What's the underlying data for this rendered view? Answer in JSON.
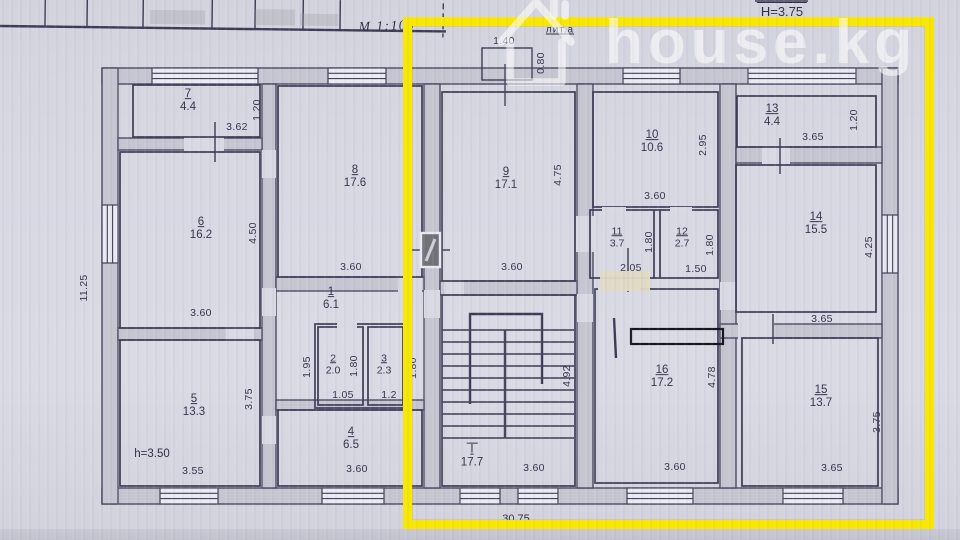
{
  "watermark": {
    "text": "house.kg"
  },
  "header": {
    "height_note": "Н=3.75",
    "scale_note": "М 1:100",
    "liter_label": "лит.а"
  },
  "overall": {
    "width": "30.75",
    "depth": "11.25",
    "ceiling_note": "h=3.50",
    "porch_width": "1.40",
    "porch_depth": "0.80",
    "lobby_depth": "1.95"
  },
  "rooms": {
    "r1": {
      "num": "1",
      "area": "6.1"
    },
    "r2": {
      "num": "2",
      "area": "2.0",
      "w": "1.05",
      "h": "1.80"
    },
    "r3": {
      "num": "3",
      "area": "2.3",
      "w": "1.2",
      "h": "1.80"
    },
    "r4": {
      "num": "4",
      "area": "6.5",
      "w": "3.60"
    },
    "r5": {
      "num": "5",
      "area": "13.3",
      "w": "3.55",
      "h": "3.75"
    },
    "r6": {
      "num": "6",
      "area": "16.2",
      "w": "3.60",
      "h": "4.50"
    },
    "r7": {
      "num": "7",
      "area": "4.4",
      "w": "3.62",
      "h": "1.20"
    },
    "r8": {
      "num": "8",
      "area": "17.6",
      "w": "3.60",
      "h": "4.75"
    },
    "r9": {
      "num": "9",
      "area": "17.1",
      "w": "3.60",
      "h": "4.75"
    },
    "r10": {
      "num": "10",
      "area": "10.6",
      "w": "3.60",
      "h": "2.95"
    },
    "r11": {
      "num": "11",
      "area": "3.7",
      "w": "2.05",
      "h": "1.80"
    },
    "r12": {
      "num": "12",
      "area": "2.7",
      "w": "1.50",
      "h": "1.80"
    },
    "r13": {
      "num": "13",
      "area": "4.4",
      "w": "3.65",
      "h": "1.20"
    },
    "r14": {
      "num": "14",
      "area": "15.5",
      "w": "3.65",
      "h": "4.25"
    },
    "r15": {
      "num": "15",
      "area": "13.7",
      "w": "3.65",
      "h": "3.75"
    },
    "r16": {
      "num": "16",
      "area": "17.2",
      "w": "3.60",
      "h": "4.78"
    },
    "st": {
      "num": "I",
      "area": "17.7",
      "w": "3.60",
      "h": "4.92"
    }
  },
  "colors": {
    "paper": "#d7d7e2",
    "ink": "#3b3b52",
    "wall_fill": "#c6c6d2",
    "highlight": "#f8e605",
    "watermark": "rgba(255,255,255,0.56)"
  }
}
